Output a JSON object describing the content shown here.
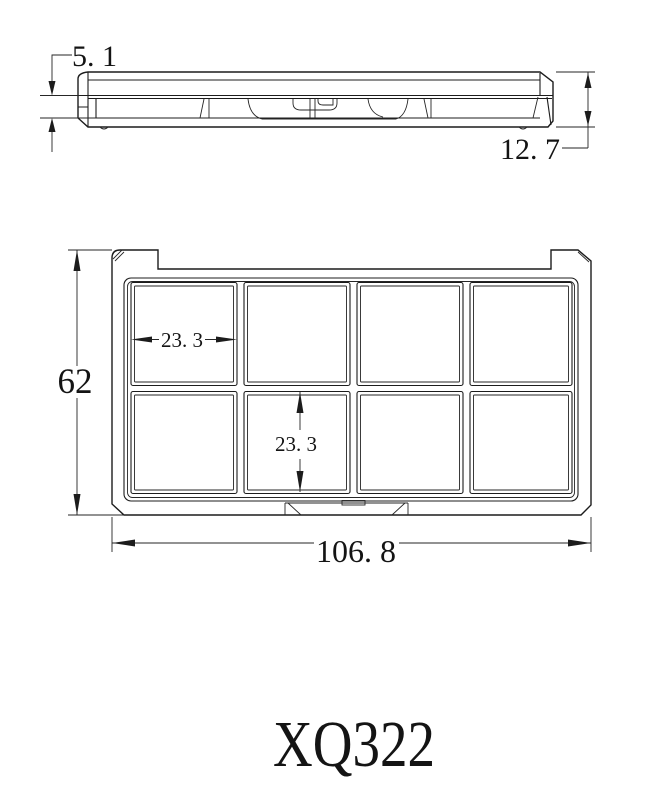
{
  "drawing": {
    "product_code": "XQ322",
    "colors": {
      "line": "#1c1c1c",
      "background": "#ffffff",
      "text": "#141414"
    },
    "side_view": {
      "description": "side profile of closed palette",
      "dims": {
        "lid_height": "5. 1",
        "total_height": "12. 7"
      }
    },
    "front_view": {
      "description": "open palette tray with 2 x 4 pan grid",
      "grid": {
        "rows": 2,
        "cols": 4,
        "cells": 8
      },
      "dims": {
        "overall_height": "62",
        "overall_width": "106. 8",
        "cell_width": "23. 3",
        "cell_height": "23. 3"
      }
    }
  }
}
